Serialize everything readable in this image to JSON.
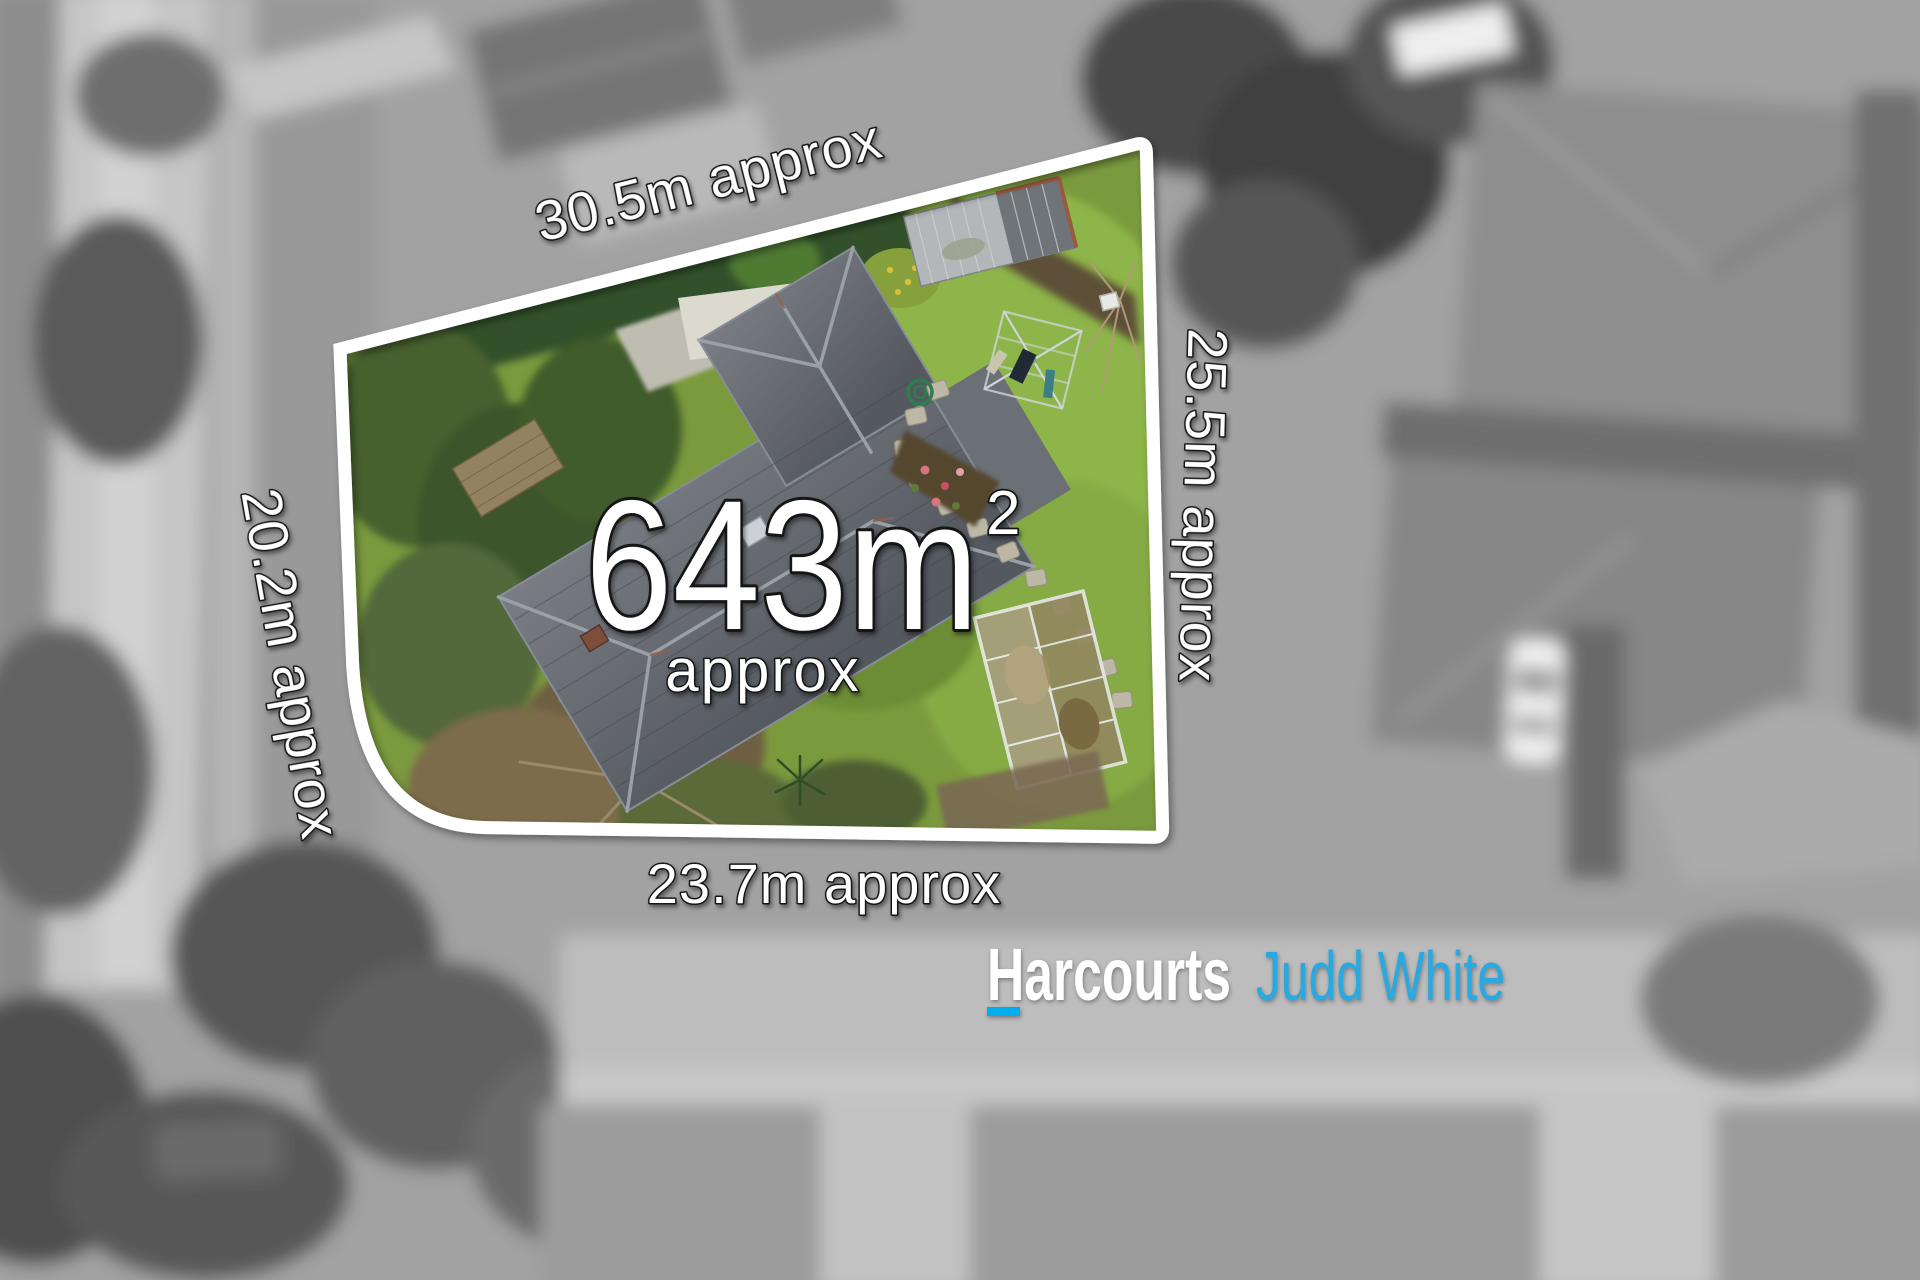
{
  "lot": {
    "area_value": "643m",
    "area_exponent": "2",
    "area_qualifier": "approx",
    "dimensions": {
      "top": "30.5m approx",
      "right": "25.5m approx",
      "bottom": "23.7m approx",
      "left": "20.2m approx"
    }
  },
  "branding": {
    "name": "Harcourts",
    "office": "Judd White",
    "name_color": "#ffffff",
    "office_color": "#29a9e2",
    "underline_color": "#00aeef"
  },
  "colors": {
    "boundary_line": "#ffffff",
    "label_fill": "#ffffff",
    "label_outline": "#161616",
    "lawn_green": "#7b9a3e",
    "roof_gray": "#5d6167",
    "exterior_grayscale_base": "#a2a2a2"
  }
}
